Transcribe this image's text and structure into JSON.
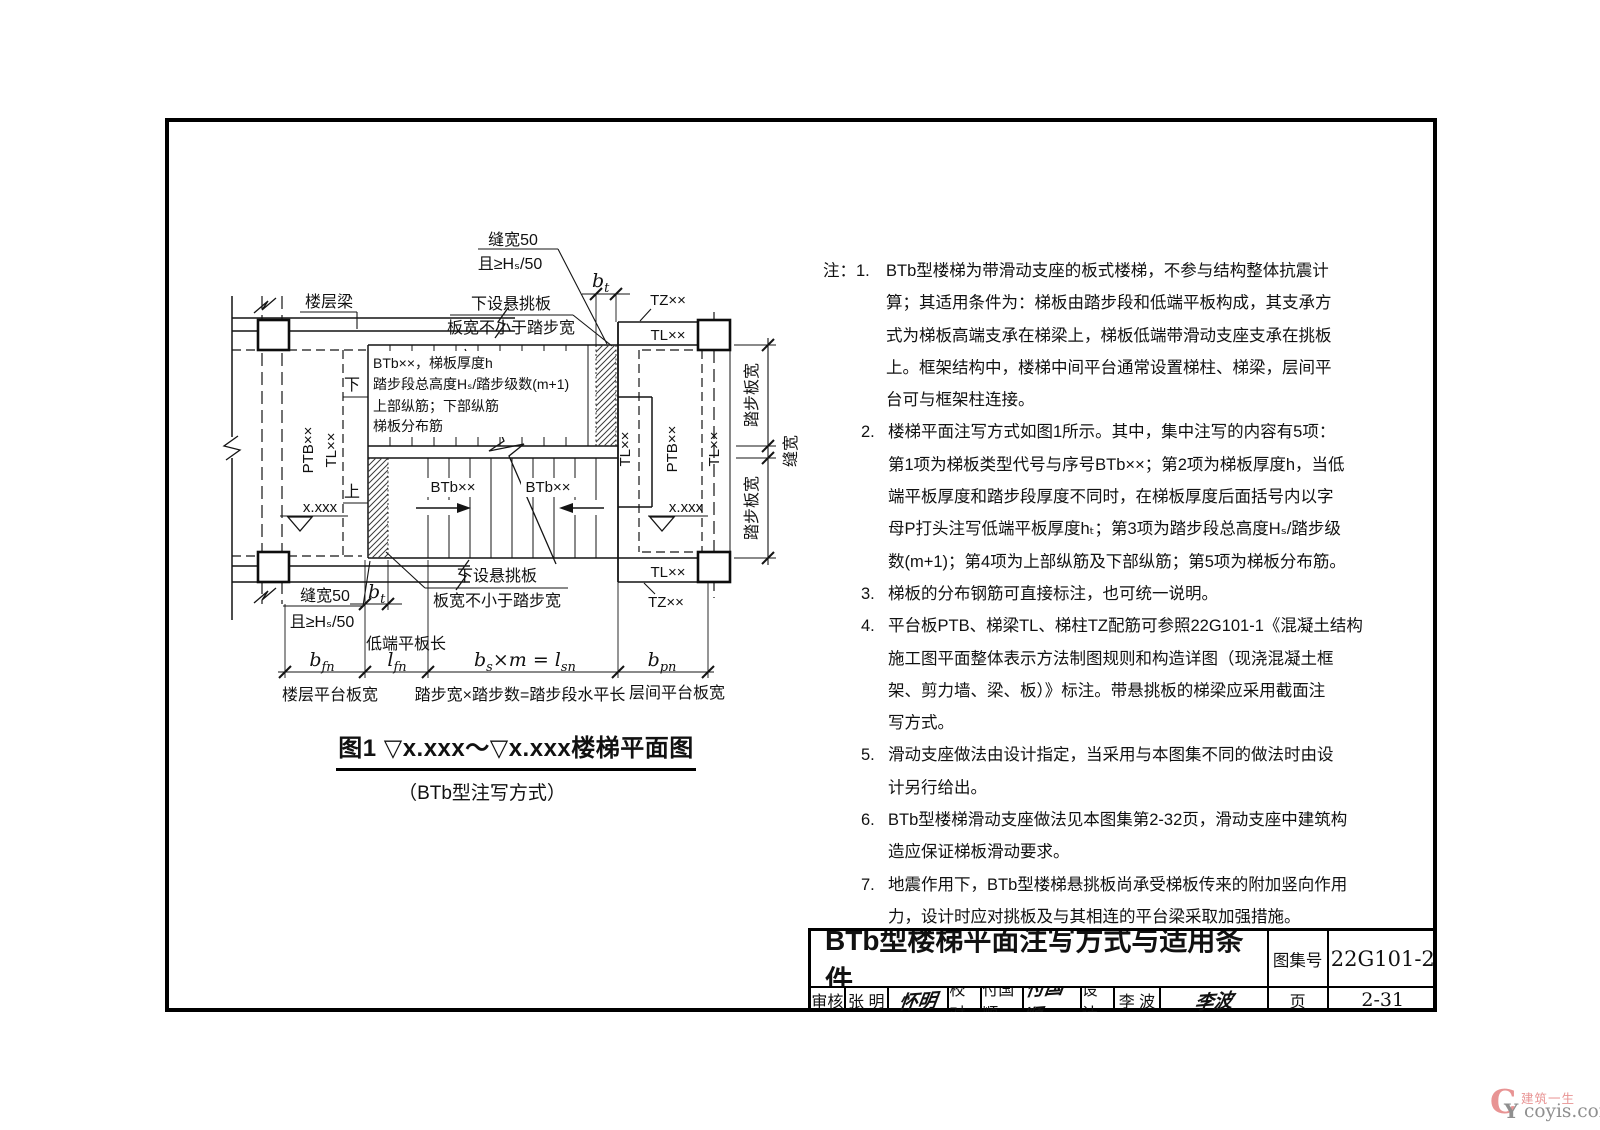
{
  "diagram": {
    "top_gap_note_line1": "缝宽50",
    "top_gap_note_line2": "且≥Hₛ/50",
    "floor_beam_label": "楼层梁",
    "cantilever_note_top_line1": "下设悬挑板",
    "cantilever_note_top_line2": "板宽不小于踏步宽",
    "tz_top": "TZ××",
    "tl_top": "TL××",
    "flight_note": {
      "l1": "BTb××，梯板厚度h",
      "l2": "踏步段总高度Hₛ/踏步级数(m+1)",
      "l3": "上部纵筋；下部纵筋",
      "l4": "梯板分布筋"
    },
    "down_label": "下",
    "up_label": "上",
    "ptb_left": "PTB××",
    "tl_left": "TL××",
    "tl_mid": "TL××",
    "ptb_right": "PTB××",
    "tl_right": "TL××",
    "elev_left": "x.xxx",
    "elev_right": "x.xxx",
    "btb_arrow1": "BTb××",
    "btb_arrow2": "BTb××",
    "tread_width_top": "踏步板宽",
    "gap_width_right": "缝宽",
    "tread_width_bottom": "踏步板宽",
    "tl_bottom": "TL××",
    "tz_bottom": "TZ××",
    "bottom_gap_note_line1": "缝宽50",
    "bottom_gap_note_line2": "且≥Hₛ/50",
    "cantilever_note_bottom_line1": "下设悬挑板",
    "cantilever_note_bottom_line2": "板宽不小于踏步宽",
    "low_slab_label": "低端平板长",
    "dims": {
      "bt": {
        "main": "b",
        "sub": "t"
      },
      "bfn": {
        "main": "b",
        "sub": "fn"
      },
      "lfn": {
        "main": "l",
        "sub": "fn"
      },
      "bsm": {
        "p1": "b",
        "p2": "s",
        "p3": "×m = ",
        "p4": "l",
        "p5": "sn"
      },
      "bpn": {
        "main": "b",
        "sub": "pn"
      }
    },
    "axis_labels": {
      "floor_platform": "楼层平台板宽",
      "steps": "踏步宽×踏步数=踏步段水平长",
      "mid_platform": "层间平台板宽"
    }
  },
  "caption": {
    "title": "图1  ▽x.xxx～▽x.xxx楼梯平面图",
    "subtitle": "（BTb型注写方式）"
  },
  "notes": {
    "items": [
      {
        "num": "注：1.",
        "text": "BTb型楼梯为带滑动支座的板式楼梯，不参与结构整体抗震计\n算；其适用条件为：梯板由踏步段和低端平板构成，其支承方\n式为梯板高端支承在梯梁上，梯板低端带滑动支座支承在挑板\n上。框架结构中，楼梯中间平台通常设置梯柱、梯梁，层间平\n台可与框架柱连接。"
      },
      {
        "num": "2.",
        "text": "楼梯平面注写方式如图1所示。其中，集中注写的内容有5项：\n第1项为梯板类型代号与序号BTb××；第2项为梯板厚度h，当低\n端平板厚度和踏步段厚度不同时，在梯板厚度后面括号内以字\n母P打头注写低端平板厚度hₜ；第3项为踏步段总高度Hₛ/踏步级\n数(m+1)；第4项为上部纵筋及下部纵筋；第5项为梯板分布筋。"
      },
      {
        "num": "3.",
        "text": "梯板的分布钢筋可直接标注，也可统一说明。"
      },
      {
        "num": "4.",
        "text": "平台板PTB、梯梁TL、梯柱TZ配筋可参照22G101-1《混凝土结构\n施工图平面整体表示方法制图规则和构造详图（现浇混凝土框\n架、剪力墙、梁、板）》标注。带悬挑板的梯梁应采用截面注\n写方式。"
      },
      {
        "num": "5.",
        "text": "滑动支座做法由设计指定，当采用与本图集不同的做法时由设\n计另行给出。"
      },
      {
        "num": "6.",
        "text": "BTb型楼梯滑动支座做法见本图集第2-32页，滑动支座中建筑构\n造应保证梯板滑动要求。"
      },
      {
        "num": "7.",
        "text": "地震作用下，BTb型楼梯悬挑板尚承受梯板传来的附加竖向作用\n力，设计时应对挑板及与其相连的平台梁采取加强措施。"
      }
    ]
  },
  "titleblock": {
    "title": "BTb型楼梯平面注写方式与适用条件",
    "atlas_label": "图集号",
    "atlas_no": "22G101-2",
    "page_label": "页",
    "page_no": "2-31",
    "cells": [
      {
        "label": "审核",
        "name": "张 明",
        "sig": "怀明"
      },
      {
        "label": "校对",
        "name": "付国顺",
        "sig": "付国顺"
      },
      {
        "label": "设计",
        "name": "李 波",
        "sig": "李波"
      }
    ]
  },
  "watermark": {
    "logo_c": "C",
    "logo_y": "Y",
    "brand": "建筑一生",
    "site": "coyis.com"
  }
}
